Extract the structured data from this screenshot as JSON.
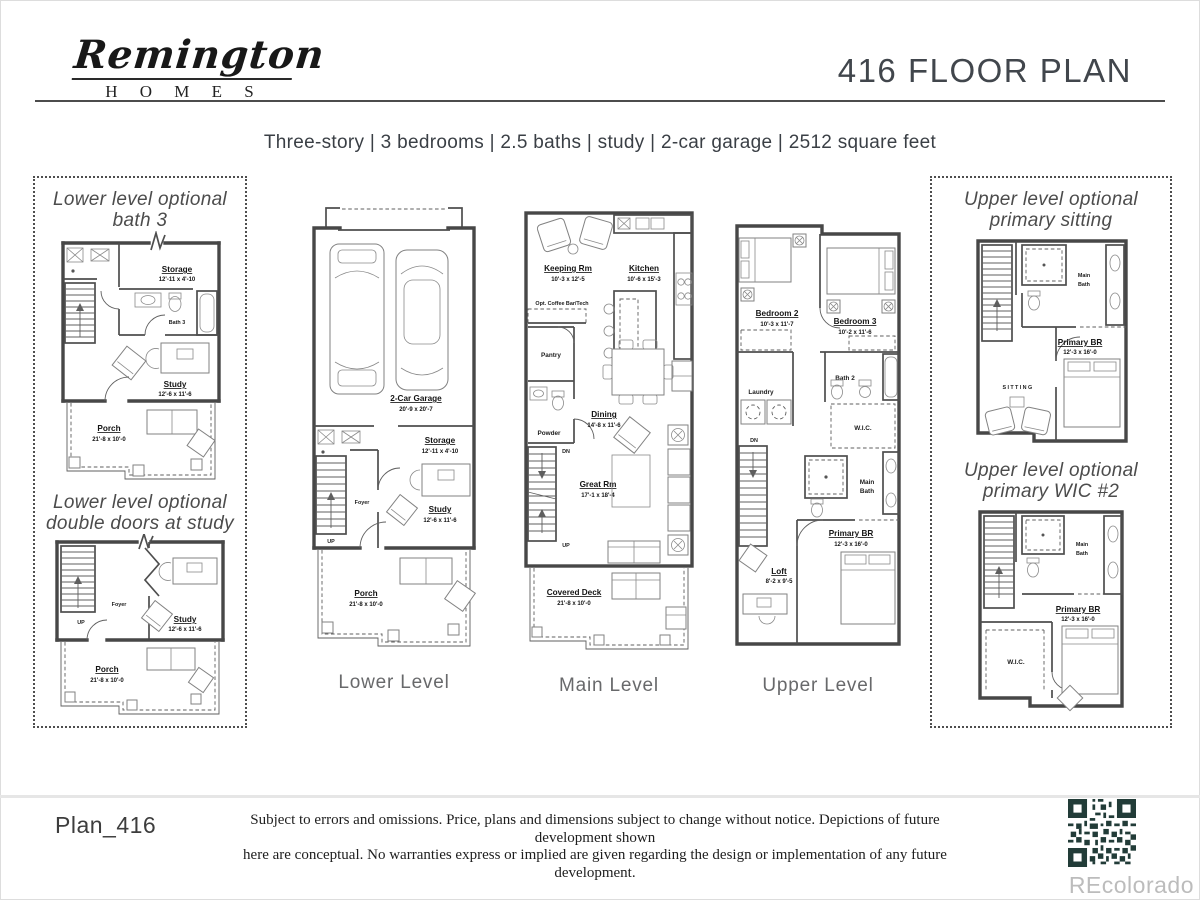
{
  "header": {
    "brand_script": "Remington",
    "brand_sub": "H O M E S",
    "title": "416 FLOOR PLAN"
  },
  "summary": "Three-story | 3 bedrooms | 2.5 baths | study | 2-car garage | 2512 square feet",
  "levels": {
    "lower": {
      "label": "Lower Level",
      "garage_name": "2-Car Garage",
      "garage_dims": "20'-9 x 20'-7",
      "storage_name": "Storage",
      "storage_dims": "12'-11 x 4'-10",
      "foyer": "Foyer",
      "up": "UP",
      "study_name": "Study",
      "study_dims": "12'-6 x 11'-6",
      "porch_name": "Porch",
      "porch_dims": "21'-8 x 10'-0"
    },
    "main": {
      "label": "Main Level",
      "keeping_name": "Keeping Rm",
      "keeping_dims": "10'-3 x 12'-5",
      "kitchen_name": "Kitchen",
      "kitchen_dims": "10'-6 x 15'-3",
      "coffee_bar": "Opt. Coffee Bar/Tech",
      "pantry": "Pantry",
      "powder": "Powder",
      "dining_name": "Dining",
      "dining_dims": "14'-8 x 11'-6",
      "great_name": "Great Rm",
      "great_dims": "17'-1 x 18'-4",
      "deck_name": "Covered Deck",
      "deck_dims": "21'-8 x 10'-0",
      "dn": "DN",
      "up": "UP"
    },
    "upper": {
      "label": "Upper Level",
      "bedroom2_name": "Bedroom 2",
      "bedroom2_dims": "10'-3 x 11'-7",
      "bedroom3_name": "Bedroom 3",
      "bedroom3_dims": "10'-2 x 11'-6",
      "laundry": "Laundry",
      "bath2": "Bath 2",
      "wic": "W.I.C.",
      "main_bath_1": "Main",
      "main_bath_2": "Bath",
      "primary_name": "Primary BR",
      "primary_dims": "12'-3 x 16'-0",
      "loft_name": "Loft",
      "loft_dims": "8'-2 x 9'-5",
      "dn": "DN"
    }
  },
  "options": {
    "lower_bath3": {
      "title1": "Lower level optional",
      "title2": "bath 3",
      "storage_name": "Storage",
      "storage_dims": "12'-11 x 4'-10",
      "bath3": "Bath 3",
      "study_name": "Study",
      "study_dims": "12'-6 x 11'-6",
      "porch_name": "Porch",
      "porch_dims": "21'-8 x 10'-0"
    },
    "lower_doors": {
      "title1": "Lower level optional",
      "title2": "double doors at study",
      "foyer": "Foyer",
      "up": "UP",
      "study_name": "Study",
      "study_dims": "12'-6 x 11'-6",
      "porch_name": "Porch",
      "porch_dims": "21'-8 x 10'-0"
    },
    "upper_sitting": {
      "title1": "Upper level optional",
      "title2": "primary sitting",
      "main_bath_1": "Main",
      "main_bath_2": "Bath",
      "primary_name": "Primary BR",
      "primary_dims": "12'-3 x 16'-0",
      "sitting": "SITTING"
    },
    "upper_wic": {
      "title1": "Upper level optional",
      "title2": "primary WIC #2",
      "main_bath_1": "Main",
      "main_bath_2": "Bath",
      "primary_name": "Primary BR",
      "primary_dims": "12'-3 x 16'-0",
      "wic": "W.I.C."
    }
  },
  "footer": {
    "plan_id": "Plan_416",
    "disclaimer_line1": "Subject to errors and omissions.  Price, plans and dimensions subject to change without notice. Depictions of future development shown",
    "disclaimer_line2": "here are conceptual. No warranties express or implied are given regarding the design or implementation of any future development.",
    "watermark": "REcolorado"
  }
}
